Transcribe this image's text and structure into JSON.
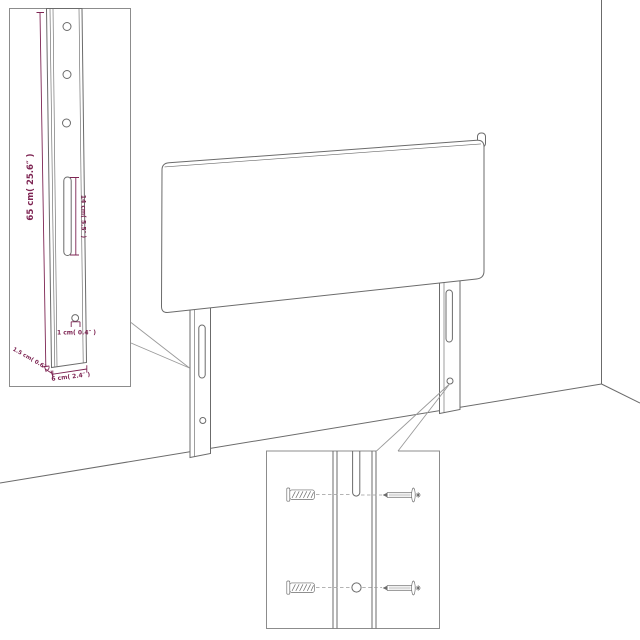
{
  "colors": {
    "background": "#ffffff",
    "outline": "#6b6b6b",
    "inset_border": "#8c8c8c",
    "leader": "#9a9a9a",
    "dimension": "#7e2553"
  },
  "insets": {
    "leg_detail": {
      "labels": {
        "height": "65 cm( 25.6″ )",
        "slot": "14 cm( 5.5″ )",
        "hole": "1 cm( 0.4″ )",
        "thickness": "1.5 cm( 0.6″ )",
        "width": "6 cm( 2.4″ )"
      }
    },
    "hardware_detail": {
      "parts": [
        "wall-plug",
        "screw"
      ]
    }
  }
}
